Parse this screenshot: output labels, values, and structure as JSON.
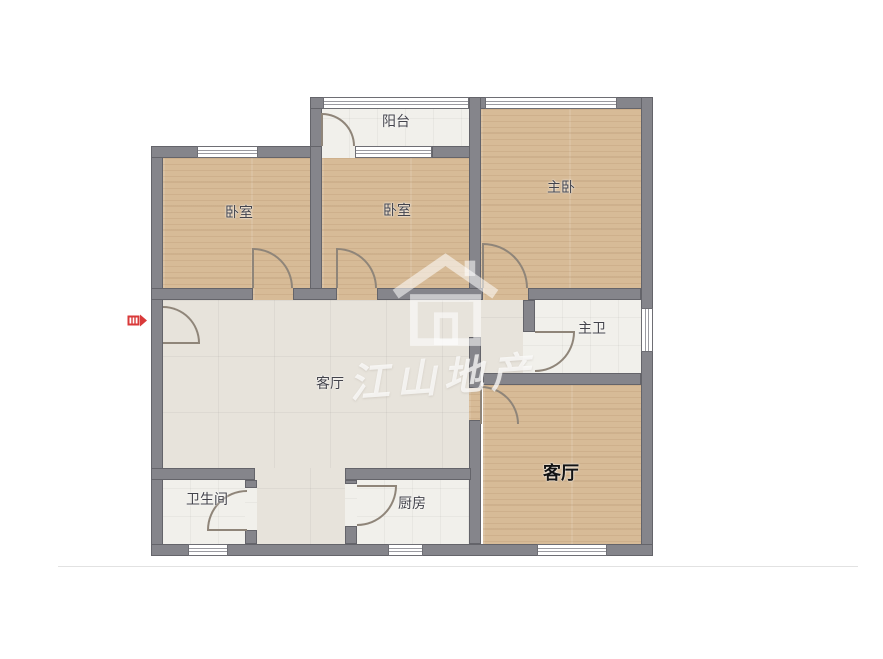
{
  "floorplan": {
    "rooms": {
      "bedroom_left": {
        "label": "卧室"
      },
      "bedroom_middle": {
        "label": "卧室"
      },
      "master_bedroom": {
        "label": "主卧"
      },
      "balcony": {
        "label": "阳台"
      },
      "master_bathroom": {
        "label": "主卫"
      },
      "living_room": {
        "label": "客厅"
      },
      "bathroom": {
        "label": "卫生间"
      },
      "kitchen": {
        "label": "厨房"
      },
      "second_living_room": {
        "label": "客厅"
      }
    },
    "watermark": {
      "text": "江山地产",
      "logo": "house-logo-icon"
    },
    "entrance_marker": {
      "icon": "entrance-arrow-icon",
      "color": "#d93a3a"
    },
    "colors": {
      "wall": "#85858b",
      "wood_floor": "#d7bb97",
      "living_floor": "#e7e3db",
      "tile_floor": "#f1f0eb",
      "door_arc": "#8f8579",
      "window": "#ffffff"
    }
  }
}
